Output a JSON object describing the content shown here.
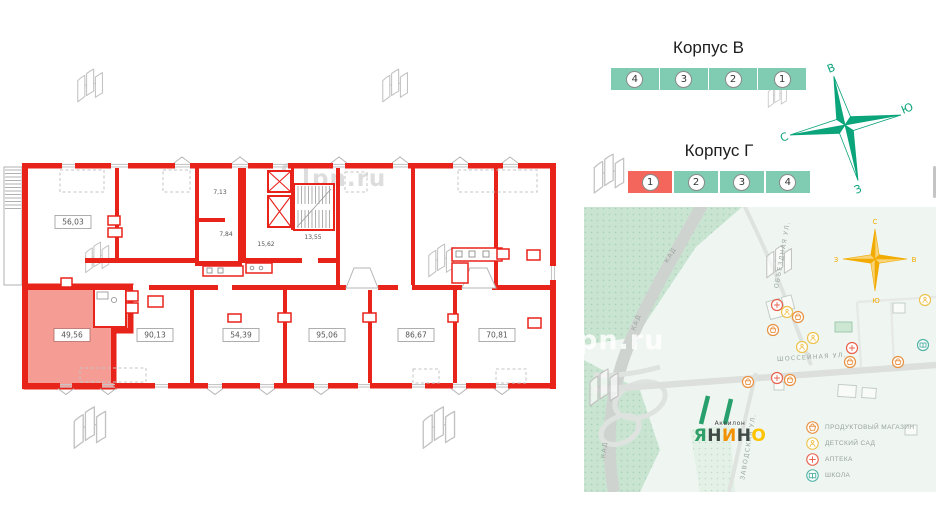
{
  "watermark": {
    "text": "pn.ru"
  },
  "floorplan": {
    "colors": {
      "wall": "#e8231a",
      "highlight": "#f59c95"
    },
    "rooms": [
      {
        "id": "room-5603",
        "area": "56,03",
        "highlighted": false
      },
      {
        "id": "room-4956",
        "area": "49,56",
        "highlighted": true
      },
      {
        "id": "room-9013",
        "area": "90,13",
        "highlighted": false
      },
      {
        "id": "room-5439",
        "area": "54,39",
        "highlighted": false
      },
      {
        "id": "room-9506",
        "area": "95,06",
        "highlighted": false
      },
      {
        "id": "room-8667",
        "area": "86,67",
        "highlighted": false
      },
      {
        "id": "room-7081",
        "area": "70,81",
        "highlighted": false
      },
      {
        "id": "room-713",
        "area": "7,13",
        "highlighted": false
      },
      {
        "id": "room-784",
        "area": "7,84",
        "highlighted": false
      },
      {
        "id": "room-1562",
        "area": "15,62",
        "highlighted": false
      },
      {
        "id": "room-1355",
        "area": "13,55",
        "highlighted": false
      }
    ]
  },
  "buildings": [
    {
      "title": "Корпус В",
      "sections": [
        "4",
        "3",
        "2",
        "1"
      ],
      "active_index": -1
    },
    {
      "title": "Корпус Г",
      "sections": [
        "1",
        "2",
        "3",
        "4"
      ],
      "active_index": 0
    }
  ],
  "compass": {
    "top": "В",
    "right": "Ю",
    "left": "С",
    "bottom": "З",
    "color": "#0ba47b"
  },
  "map": {
    "compass": {
      "top": "С",
      "right": "В",
      "left": "З",
      "bottom": "Ю",
      "color": "#f2ab00"
    },
    "streets": [
      "КАД",
      "КАД",
      "КАД",
      "ОБЪЕЗДНАЯ УЛ.",
      "ШОССЕЙНАЯ УЛ.",
      "ЗАВОДСКАЯ УЛ."
    ],
    "logo": {
      "brand": "Аквилон",
      "name": "ЯНИНО",
      "letters": [
        {
          "ch": "Я",
          "color": "#2f9e68"
        },
        {
          "ch": "Н",
          "color": "#3f4a46"
        },
        {
          "ch": "И",
          "color": "#f29100"
        },
        {
          "ch": "Н",
          "color": "#3f4a46"
        },
        {
          "ch": "О",
          "color": "#ffc400"
        }
      ]
    },
    "legend": [
      {
        "label": "ПРОДУКТОВЫЙ МАГАЗИН",
        "icon": "basket",
        "color": "#e8903f"
      },
      {
        "label": "ДЕТСКИЙ САД",
        "icon": "kid",
        "color": "#edc24d"
      },
      {
        "label": "АПТЕКА",
        "icon": "cross",
        "color": "#e8614d"
      },
      {
        "label": "ШКОЛА",
        "icon": "book",
        "color": "#53b3a6"
      }
    ],
    "pois": [
      {
        "x": 193,
        "y": 98,
        "type": "cross"
      },
      {
        "x": 203,
        "y": 105,
        "type": "kid"
      },
      {
        "x": 214,
        "y": 110,
        "type": "basket"
      },
      {
        "x": 189,
        "y": 123,
        "type": "basket"
      },
      {
        "x": 229,
        "y": 131,
        "type": "kid"
      },
      {
        "x": 218,
        "y": 140,
        "type": "kid"
      },
      {
        "x": 268,
        "y": 141,
        "type": "cross"
      },
      {
        "x": 341,
        "y": 93,
        "type": "kid"
      },
      {
        "x": 339,
        "y": 138,
        "type": "book"
      },
      {
        "x": 266,
        "y": 155,
        "type": "basket"
      },
      {
        "x": 314,
        "y": 155,
        "type": "basket"
      },
      {
        "x": 193,
        "y": 171,
        "type": "cross"
      },
      {
        "x": 206,
        "y": 173,
        "type": "basket"
      },
      {
        "x": 164,
        "y": 175,
        "type": "basket"
      }
    ]
  }
}
